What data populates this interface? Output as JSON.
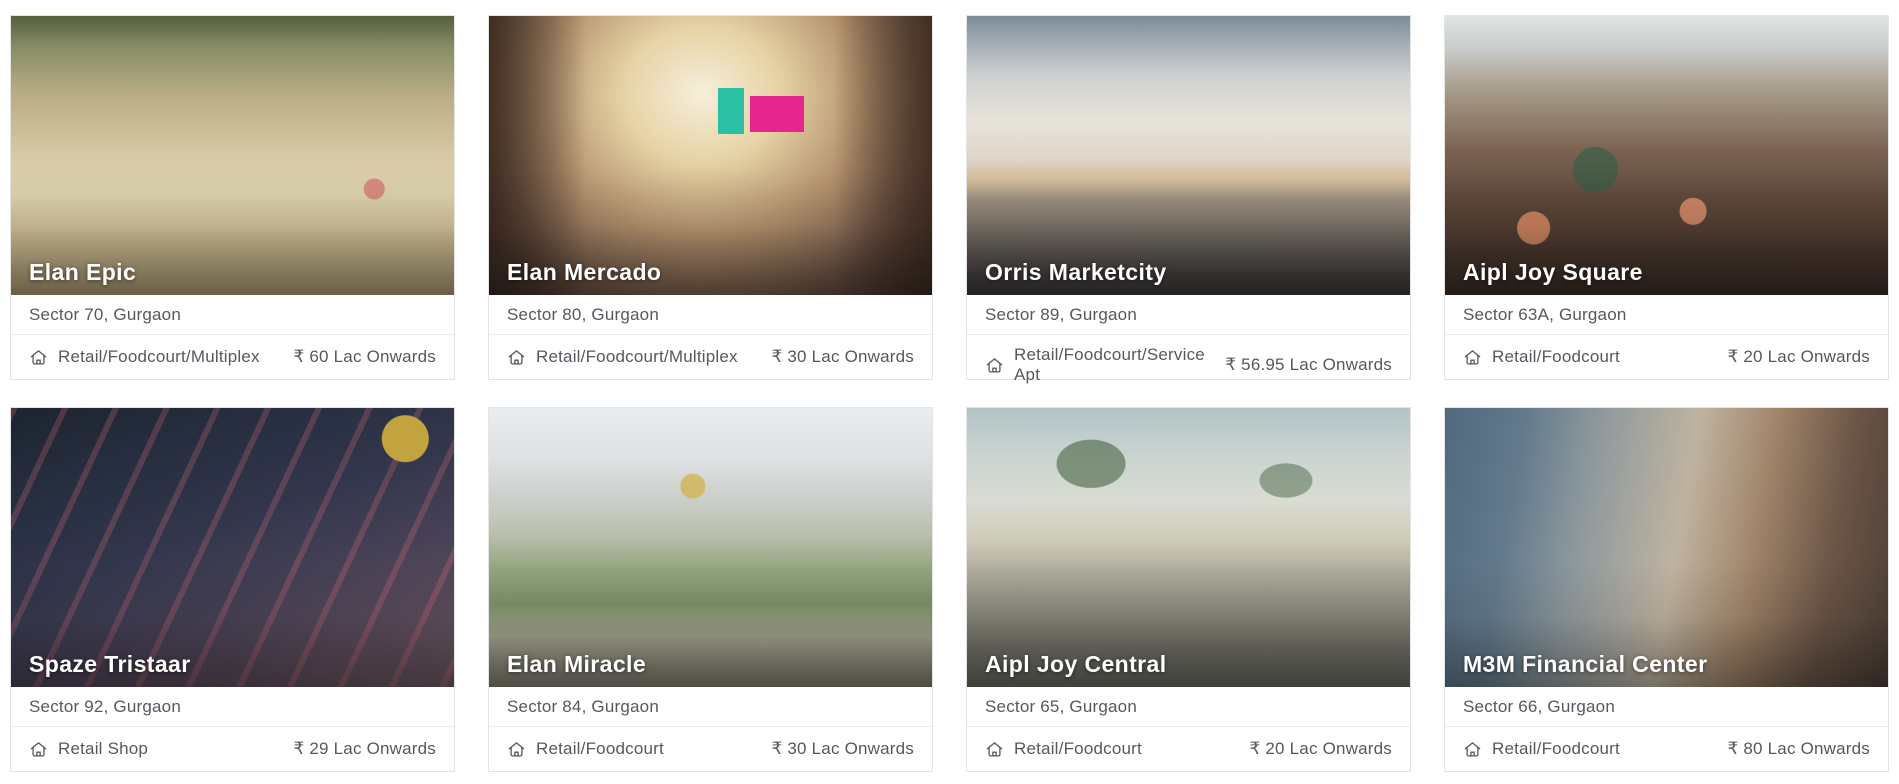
{
  "listings": {
    "type_icon": "home-outline-icon",
    "currency_symbol": "₹",
    "cards": [
      {
        "title": "Elan Epic",
        "location": "Sector 70, Gurgaon",
        "property_type": "Retail/Foodcourt/Multiplex",
        "price": "₹ 60 Lac Onwards",
        "image": "elan-epic-plaza-render"
      },
      {
        "title": "Elan Mercado",
        "location": "Sector 80, Gurgaon",
        "property_type": "Retail/Foodcourt/Multiplex",
        "price": "₹ 30 Lac Onwards",
        "image": "elan-mercado-mall-interior-render"
      },
      {
        "title": "Orris Marketcity",
        "location": "Sector 89, Gurgaon",
        "property_type": "Retail/Foodcourt/Service Apt",
        "price": "₹ 56.95 Lac Onwards",
        "image": "orris-marketcity-exterior-render"
      },
      {
        "title": "Aipl Joy Square",
        "location": "Sector 63A, Gurgaon",
        "property_type": "Retail/Foodcourt",
        "price": "₹ 20 Lac Onwards",
        "image": "aipl-joy-square-atrium-render"
      },
      {
        "title": "Spaze Tristaar",
        "location": "Sector 92, Gurgaon",
        "property_type": "Retail Shop",
        "price": "₹ 29 Lac Onwards",
        "image": "spaze-tristaar-night-aerial-render"
      },
      {
        "title": "Elan Miracle",
        "location": "Sector 84, Gurgaon",
        "property_type": "Retail/Foodcourt",
        "price": "₹ 30 Lac Onwards",
        "image": "elan-miracle-courtyard-render"
      },
      {
        "title": "Aipl Joy Central",
        "location": "Sector 65, Gurgaon",
        "property_type": "Retail/Foodcourt",
        "price": "₹ 20 Lac Onwards",
        "image": "aipl-joy-central-street-render"
      },
      {
        "title": "M3M Financial Center",
        "location": "Sector 66, Gurgaon",
        "property_type": "Retail/Foodcourt",
        "price": "₹ 80 Lac Onwards",
        "image": "m3m-financial-center-street-render"
      }
    ]
  },
  "colors": {
    "page_background": "#ffffff",
    "card_border": "#e4e4e4",
    "card_title_text": "#ffffff",
    "body_text": "#54595f"
  }
}
